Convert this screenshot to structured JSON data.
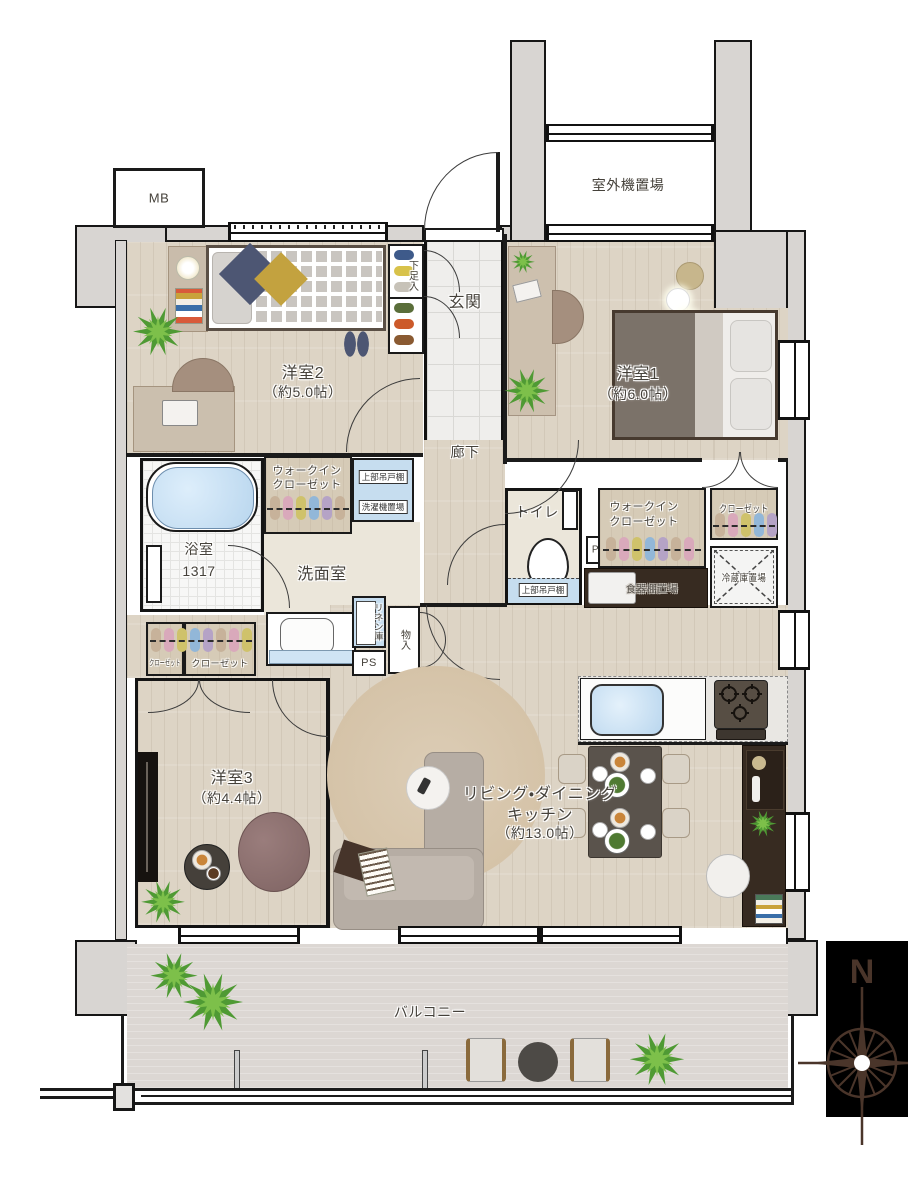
{
  "labels": {
    "mb": "MB",
    "outdoor_unit": "室外機置場",
    "genkan": "玄関",
    "shoe_cabinet": "下足入",
    "room2": {
      "name": "洋室2",
      "size": "（約5.0帖）"
    },
    "room1": {
      "name": "洋室1",
      "size": "（約6.0帖）"
    },
    "corridor": "廊下",
    "wic_left": {
      "line1": "ウォークイン",
      "line2": "クローゼット"
    },
    "upper_cabinet_laundry": "上部吊戸棚",
    "washer": "洗濯機置場",
    "bath": {
      "name": "浴室",
      "size": "1317"
    },
    "washroom": "洗面室",
    "toilet": "トイレ",
    "upper_cabinet_toilet": "上部吊戸棚",
    "ps_left": "PS",
    "ps_right": "PS",
    "linen": "リネン庫",
    "storage": "物入",
    "closet_small_left": "クローゼット",
    "closet_small_right": "クローゼット",
    "wic_right": {
      "line1": "ウォークイン",
      "line2": "クローゼット"
    },
    "closet_right": "クローゼット",
    "fridge": "冷蔵庫置場",
    "cupboard": "食器棚置場",
    "room3": {
      "name": "洋室3",
      "size": "（約4.4帖）"
    },
    "ldk": {
      "line1": "リビング・ダイニング",
      "line2": "キッチン",
      "line3": "（約13.0帖）"
    },
    "balcony": "バルコニー",
    "compass_north": "N"
  },
  "colors": {
    "wall_gray": "#d8d5d2",
    "wood_floor": "#ddd4c5",
    "tile": "#efeeec",
    "water_blue": "#c6ddef",
    "dark_cabinet": "#372b21",
    "compass_bg": "#000000",
    "compass_rose": "#4a352a"
  }
}
